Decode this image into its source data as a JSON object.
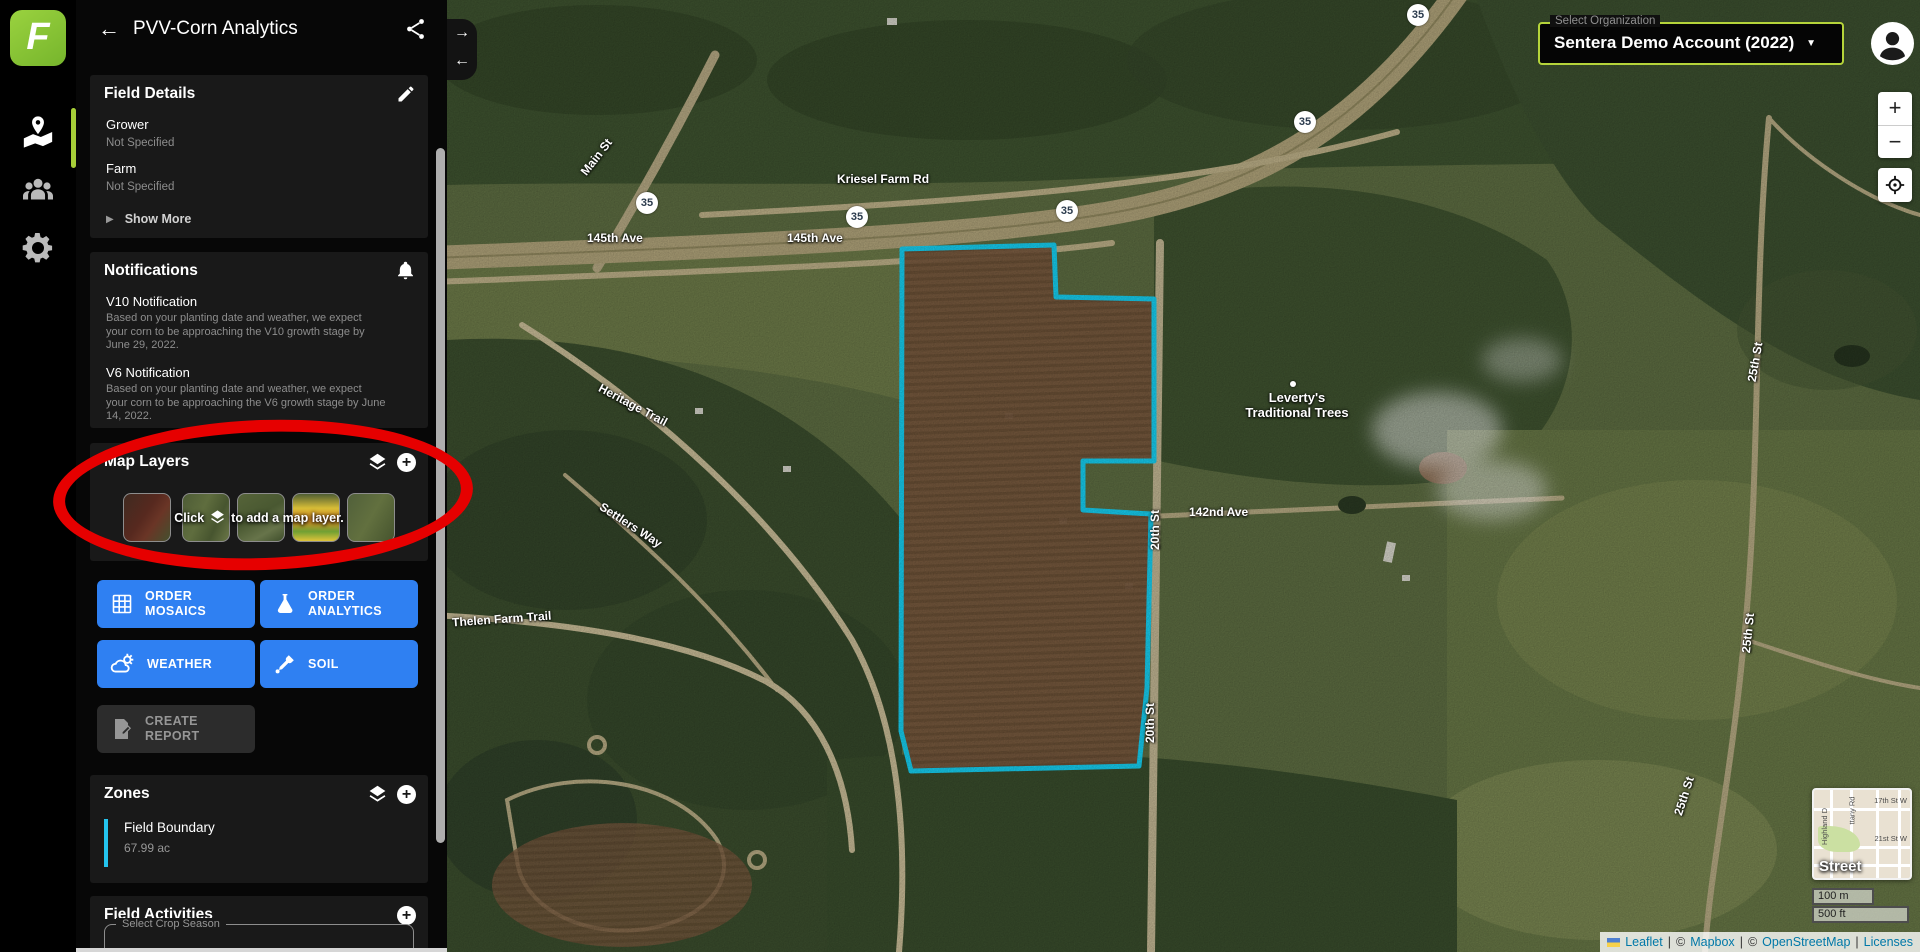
{
  "header": {
    "title": "PVV-Corn Analytics"
  },
  "icons": {
    "back": "←",
    "collapse_right": "→",
    "collapse_left": "←",
    "show_more_arrow": "▶",
    "caret": "▼",
    "plus": "+",
    "zoom_in": "+",
    "zoom_out": "−"
  },
  "sidebar": {
    "field_details": {
      "title": "Field Details",
      "rows": [
        {
          "label": "Grower",
          "value": "Not Specified"
        },
        {
          "label": "Farm",
          "value": "Not Specified"
        }
      ],
      "show_more": "Show More"
    },
    "notifications": {
      "title": "Notifications",
      "items": [
        {
          "title": "V10 Notification",
          "body": "Based on your planting date and weather, we expect your corn to be approaching the V10 growth stage by June 29, 2022."
        },
        {
          "title": "V6 Notification",
          "body": "Based on your planting date and weather, we expect your corn to be approaching the V6 growth stage by June 14, 2022."
        }
      ]
    },
    "map_layers": {
      "title": "Map Layers",
      "hint_click": "Click",
      "hint_rest": "to add a map layer."
    },
    "actions": {
      "order_mosaics": "ORDER MOSAICS",
      "order_analytics": "ORDER ANALYTICS",
      "weather": "WEATHER",
      "soil": "SOIL",
      "create_report": "CREATE REPORT"
    },
    "zones": {
      "title": "Zones",
      "items": [
        {
          "name": "Field Boundary",
          "area": "67.99 ac"
        }
      ]
    },
    "field_activities": {
      "title": "Field Activities",
      "season_label": "Select Crop Season"
    }
  },
  "org_selector": {
    "label": "Select Organization",
    "value": "Sentera Demo Account (2022)"
  },
  "map": {
    "shield": "35",
    "labels": {
      "main_st": "Main St",
      "kriesel": "Kriesel Farm Rd",
      "ave145": "145th Ave",
      "heritage": "Heritage Trail",
      "settlers": "Settlers Way",
      "thelen": "Thelen Farm Trail",
      "ave142": "142nd Ave",
      "st20": "20th St",
      "st25": "25th St",
      "poi_line1": "Leverty's",
      "poi_line2": "Traditional Trees"
    },
    "minimap": {
      "label": "Street",
      "st17": "17th St W",
      "st21": "21st St W",
      "highland": "Highland D",
      "brittany": "ttany Rd"
    },
    "scale": {
      "metric": "100 m",
      "imperial": "500 ft"
    },
    "attribution": {
      "leaflet": "Leaflet",
      "copy": "©",
      "mapbox": "Mapbox",
      "osm": "OpenStreetMap",
      "licenses": "Licenses",
      "sep": "|"
    }
  }
}
